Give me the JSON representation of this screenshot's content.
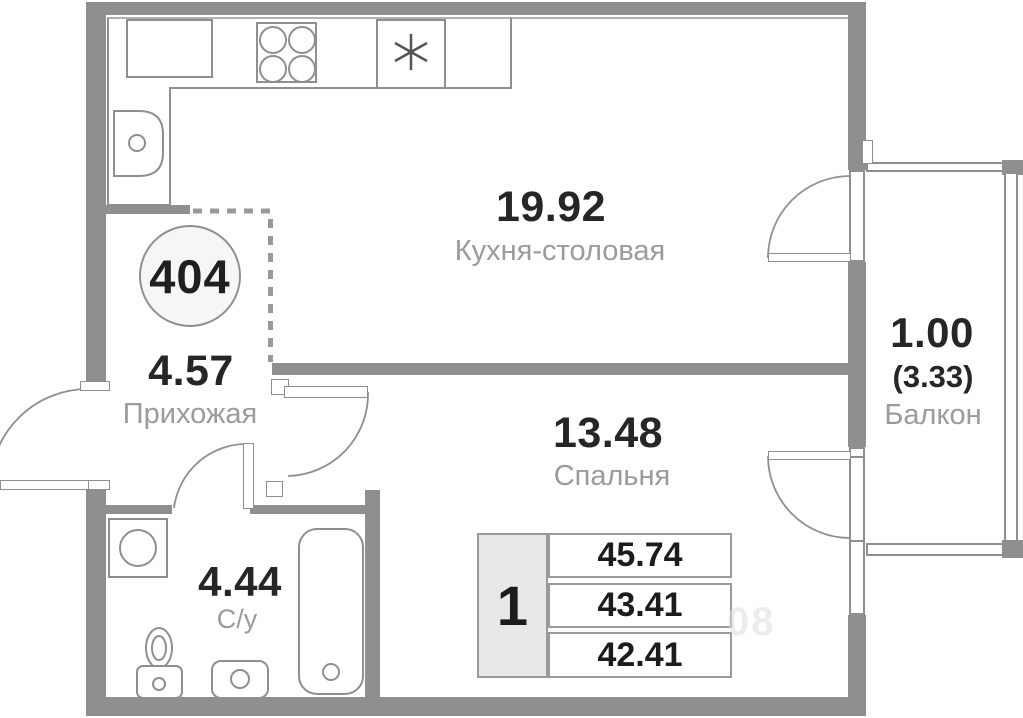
{
  "badge": {
    "number": "404"
  },
  "rooms": {
    "kitchen": {
      "area": "19.92",
      "label": "Кухня-столовая"
    },
    "hallway": {
      "area": "4.57",
      "label": "Прихожая"
    },
    "bedroom": {
      "area": "13.48",
      "label": "Спальня"
    },
    "bathroom": {
      "area": "4.44",
      "label": "С/у"
    },
    "balcony": {
      "area": "1.00",
      "area_secondary": "(3.33)",
      "label": "Балкон"
    }
  },
  "table": {
    "rooms_count": "1",
    "rows": [
      "45.74",
      "43.41",
      "42.41"
    ]
  },
  "watermark": "08",
  "colors": {
    "wall": "#8f8f8f",
    "line": "#8f8f8f",
    "area_text": "#262626",
    "label_text": "#9b9b9b",
    "table_cell_bg": "#e8e8e6",
    "badge_bg": "#f6f6f4"
  }
}
